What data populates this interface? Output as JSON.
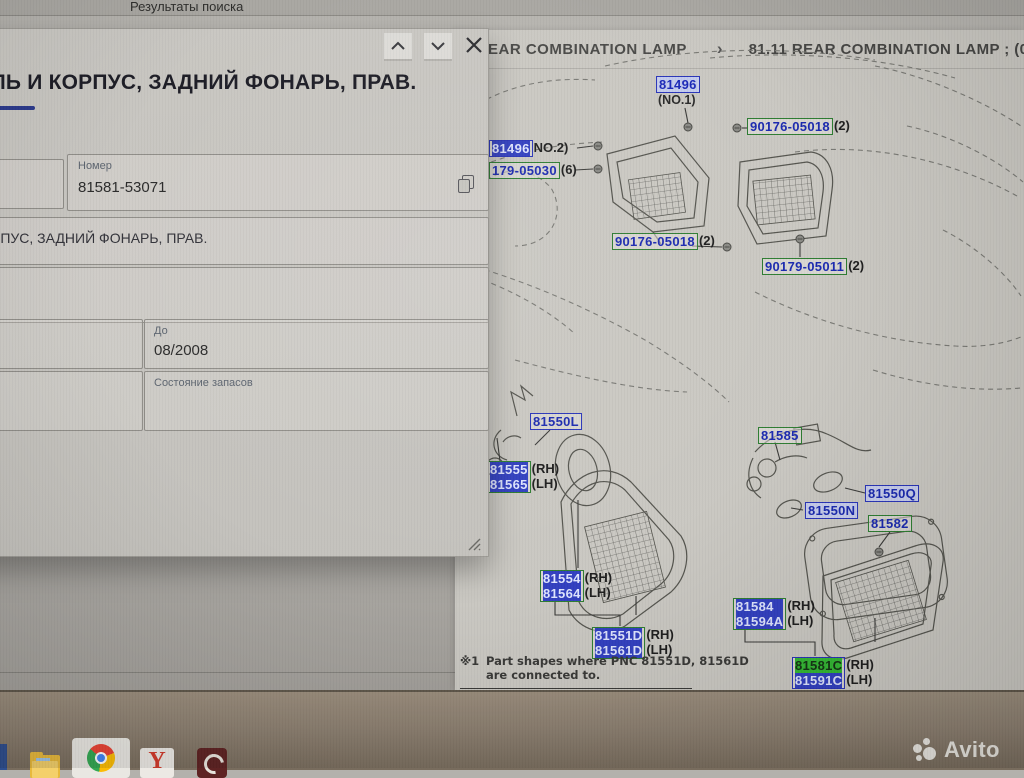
{
  "browser": {
    "tab_title": "Результаты поиска"
  },
  "popup": {
    "title": "ЛЬ И КОРПУС, ЗАДНИЙ ФОНАРЬ, ПРАВ.",
    "number_label": "Номер",
    "number_value": "81581-53071",
    "description": "РПУС, ЗАДНИЙ ФОНАРЬ, ПРАВ.",
    "until_label": "До",
    "until_value": "08/2008",
    "stock_label": "Состояние запасов",
    "icons": [
      "chevron-up-icon",
      "chevron-down-icon",
      "close-icon",
      "copy-icon",
      "resize-handle-icon"
    ]
  },
  "catalog": {
    "breadcrumb": {
      "parent": "EAR COMBINATION LAMP",
      "separator": "›",
      "current": "81.11 REAR COMBINATION LAMP ; (050"
    },
    "note": {
      "marker": "※1",
      "line1": "Part shapes where PNC 81551D, 81561D",
      "line2": "are connected to."
    },
    "labels": [
      {
        "id": "81496-no1",
        "x": 201,
        "y": 46,
        "border": "blue",
        "fill": "lav",
        "rows": [
          {
            "num": "81496",
            "sel": "light"
          }
        ],
        "under": "(NO.1)"
      },
      {
        "id": "90176-05018-a",
        "x": 292,
        "y": 88,
        "border": "green",
        "rows": [
          {
            "num": "90176-05018",
            "suffix": "(2)"
          }
        ]
      },
      {
        "id": "81496-no2",
        "x": 34,
        "y": 110,
        "border": "blue",
        "rows": [
          {
            "num": "81496",
            "sel": "blue",
            "suffix": "NO.2)"
          }
        ]
      },
      {
        "id": "179-05030",
        "x": 34,
        "y": 132,
        "border": "green",
        "rows": [
          {
            "num": "179-05030",
            "suffix": "(6)"
          }
        ]
      },
      {
        "id": "90176-05018-b",
        "x": 157,
        "y": 203,
        "border": "green",
        "rows": [
          {
            "num": "90176-05018",
            "suffix": "(2)"
          }
        ]
      },
      {
        "id": "90179-05011",
        "x": 307,
        "y": 228,
        "border": "green",
        "rows": [
          {
            "num": "90179-05011",
            "suffix": "(2)"
          }
        ]
      },
      {
        "id": "81550L",
        "x": 75,
        "y": 383,
        "border": "blue",
        "rows": [
          {
            "num": "81550L"
          }
        ]
      },
      {
        "id": "81555-81565",
        "x": 32,
        "y": 431,
        "border": "green",
        "rows": [
          {
            "num": "81555",
            "sel": "blue",
            "suffix": "(RH)"
          },
          {
            "num": "81565",
            "sel": "blue",
            "suffix": "(LH)"
          }
        ]
      },
      {
        "id": "81585",
        "x": 303,
        "y": 397,
        "border": "green",
        "rows": [
          {
            "num": "81585"
          }
        ]
      },
      {
        "id": "81550Q",
        "x": 410,
        "y": 455,
        "border": "blue",
        "fill": "lav",
        "rows": [
          {
            "num": "81550Q"
          }
        ]
      },
      {
        "id": "81550N",
        "x": 350,
        "y": 472,
        "border": "blue",
        "fill": "lav",
        "rows": [
          {
            "num": "81550N"
          }
        ]
      },
      {
        "id": "81582",
        "x": 413,
        "y": 485,
        "border": "green",
        "rows": [
          {
            "num": "81582"
          }
        ]
      },
      {
        "id": "81554-81564",
        "x": 85,
        "y": 540,
        "border": "green",
        "rows": [
          {
            "num": "81554",
            "sel": "blue",
            "suffix": "(RH)"
          },
          {
            "num": "81564",
            "sel": "blue",
            "suffix": "(LH)"
          }
        ]
      },
      {
        "id": "81551D-81561D",
        "x": 137,
        "y": 597,
        "border": "green",
        "rows": [
          {
            "num": "81551D",
            "sel": "blue",
            "suffix": "(RH)"
          },
          {
            "num": "81561D",
            "sel": "blue",
            "suffix": "(LH)"
          }
        ]
      },
      {
        "id": "81584-81594A",
        "x": 278,
        "y": 568,
        "border": "green",
        "rows": [
          {
            "num": "81584",
            "sel": "blue",
            "suffix": "(RH)"
          },
          {
            "num": "81594A",
            "sel": "blue",
            "suffix": "(LH)"
          }
        ]
      },
      {
        "id": "81581C-81591C",
        "x": 337,
        "y": 627,
        "border": "blue",
        "rows": [
          {
            "num": "81581C",
            "sel": "green",
            "suffix": "(RH)"
          },
          {
            "num": "81591C",
            "sel": "blue",
            "suffix": "(LH)"
          }
        ]
      }
    ]
  },
  "taskbar": {
    "icons": [
      "pinned-app-partial",
      "file-explorer",
      "chrome",
      "yandex-browser",
      "dark-red-app"
    ]
  },
  "watermark": {
    "logo": "avito-dots-logo",
    "text": "Avito"
  }
}
